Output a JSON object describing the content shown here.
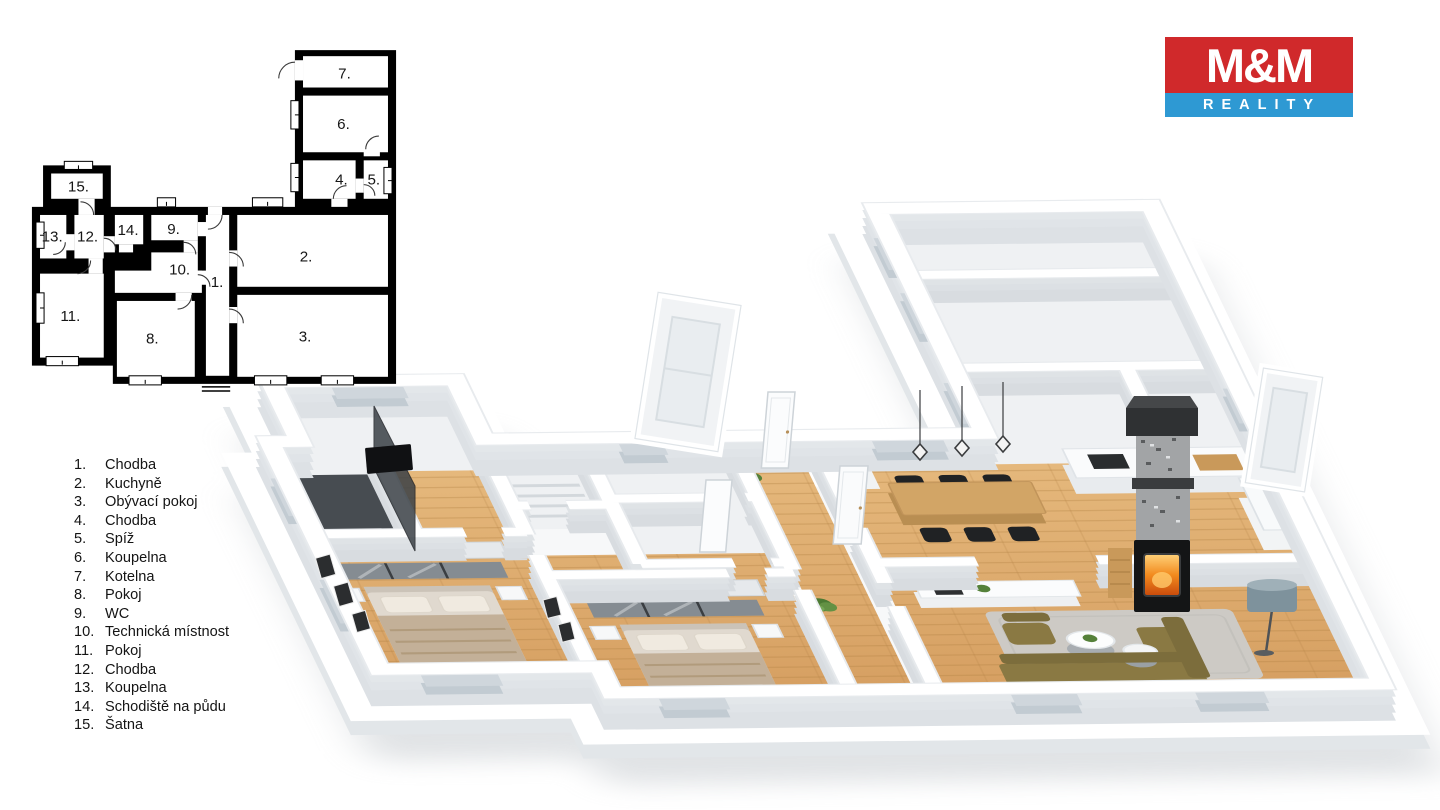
{
  "logo": {
    "title": "M&M",
    "subtitle": "REALITY"
  },
  "legend": {
    "items": [
      {
        "num": "1.",
        "label": "Chodba"
      },
      {
        "num": "2.",
        "label": "Kuchyně"
      },
      {
        "num": "3.",
        "label": "Obývací pokoj"
      },
      {
        "num": "4.",
        "label": "Chodba"
      },
      {
        "num": "5.",
        "label": "Spíž"
      },
      {
        "num": "6.",
        "label": "Koupelna"
      },
      {
        "num": "7.",
        "label": "Kotelna"
      },
      {
        "num": "8.",
        "label": "Pokoj"
      },
      {
        "num": "9.",
        "label": "WC"
      },
      {
        "num": "10.",
        "label": "Technická místnost"
      },
      {
        "num": "11.",
        "label": "Pokoj"
      },
      {
        "num": "12.",
        "label": "Chodba"
      },
      {
        "num": "13.",
        "label": "Koupelna"
      },
      {
        "num": "14.",
        "label": "Schodiště na půdu"
      },
      {
        "num": "15.",
        "label": "Šatna"
      }
    ]
  },
  "plan2d": {
    "labels": [
      "7.",
      "6.",
      "4.",
      "5.",
      "15.",
      "13.",
      "12.",
      "14.",
      "9.",
      "10.",
      "1.",
      "2.",
      "11.",
      "8.",
      "3."
    ]
  },
  "palette": {
    "logo_red": "#D0292B",
    "logo_blue": "#2E99D3",
    "wood_floor": "#DDA96B",
    "wall_gray": "#D8DCE0",
    "sofa_olive": "#8A7943",
    "rug_gray": "#CDCAC5",
    "fire_orange": "#F08020",
    "stone_gray": "#A2A4A6"
  }
}
